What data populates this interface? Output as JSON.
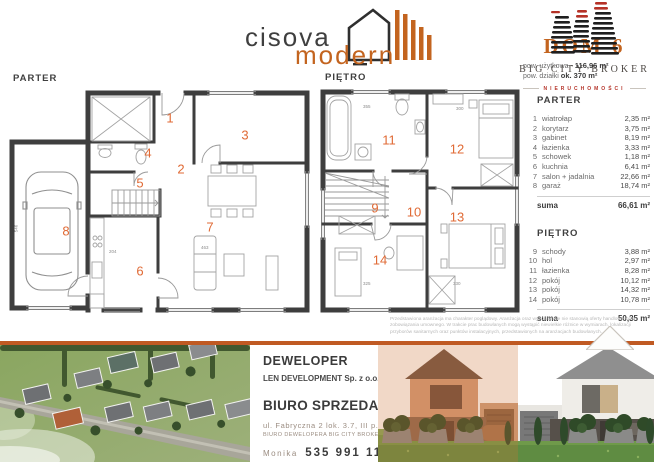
{
  "brand": {
    "line1": "cisova",
    "line2": "modern"
  },
  "broker": {
    "logo_text": "DOM 6",
    "area_usable_label": "pow. użytkowa -",
    "area_usable_value": "116,96 m²",
    "area_plot_label": "pow. działki",
    "area_plot_value": "ok. 370 m²",
    "name": "BIG CITY BROKER",
    "subtitle": "NIERUCHOMOŚCI"
  },
  "plans": {
    "parter_title": "PARTER",
    "pietro_title": "PIĘTRO"
  },
  "room_lists": {
    "parter": {
      "title": "PARTER",
      "rooms": [
        {
          "num": "1",
          "name": "wiatrołap",
          "area": "2,35 m²"
        },
        {
          "num": "2",
          "name": "korytarz",
          "area": "3,75 m²"
        },
        {
          "num": "3",
          "name": "gabinet",
          "area": "8,19 m²"
        },
        {
          "num": "4",
          "name": "łazienka",
          "area": "3,33 m²"
        },
        {
          "num": "5",
          "name": "schowek",
          "area": "1,18 m²"
        },
        {
          "num": "6",
          "name": "kuchnia",
          "area": "6,41 m²"
        },
        {
          "num": "7",
          "name": "salon + jadalnia",
          "area": "22,66 m²"
        },
        {
          "num": "8",
          "name": "garaż",
          "area": "18,74 m²"
        }
      ],
      "suma_label": "suma",
      "suma_value": "66,61 m²"
    },
    "pietro": {
      "title": "PIĘTRO",
      "rooms": [
        {
          "num": "9",
          "name": "schody",
          "area": "3,88 m²"
        },
        {
          "num": "10",
          "name": "hol",
          "area": "2,97 m²"
        },
        {
          "num": "11",
          "name": "łazienka",
          "area": "8,28 m²"
        },
        {
          "num": "12",
          "name": "pokój",
          "area": "10,12 m²"
        },
        {
          "num": "13",
          "name": "pokój",
          "area": "14,32 m²"
        },
        {
          "num": "14",
          "name": "pokój",
          "area": "10,78 m²"
        }
      ],
      "suma_label": "suma",
      "suma_value": "50,35 m²"
    }
  },
  "plan_dims": {
    "parter": [
      "204",
      "463",
      "546"
    ],
    "pietro": [
      "355",
      "300",
      "325",
      "330"
    ]
  },
  "disclaimer": "Przedstawiona aranżacja ma charakter poglądowy. Aranżacja oraz wyposażenie nie stanowią oferty handlowej oraz zobowiązania umownego. W trakcie prac budowlanych mogą wystąpić niewielkie różnice w wymiarach, lokalizacji przyborów sanitarnych oraz punktów instalacyjnych, przedstawionych na aranżacjach budowlanych.",
  "footer": {
    "developer_label": "DEWELOPER",
    "developer_name": "LEN DEVELOPMENT Sp. z o.o.",
    "office_label": "BIURO SPRZEDAŻY",
    "address": "ul. Fabryczna 2 lok. 3.7, III p.",
    "office_sub": "BIURO DEWELOPERA BIG CITY BROKER",
    "contact_name": "Monika",
    "phone": "535 991 113"
  },
  "colors": {
    "accent": "#c05a23",
    "room_number": "#e06a35",
    "logo_orange": "#c3641f",
    "broker_red": "#b5342a"
  }
}
